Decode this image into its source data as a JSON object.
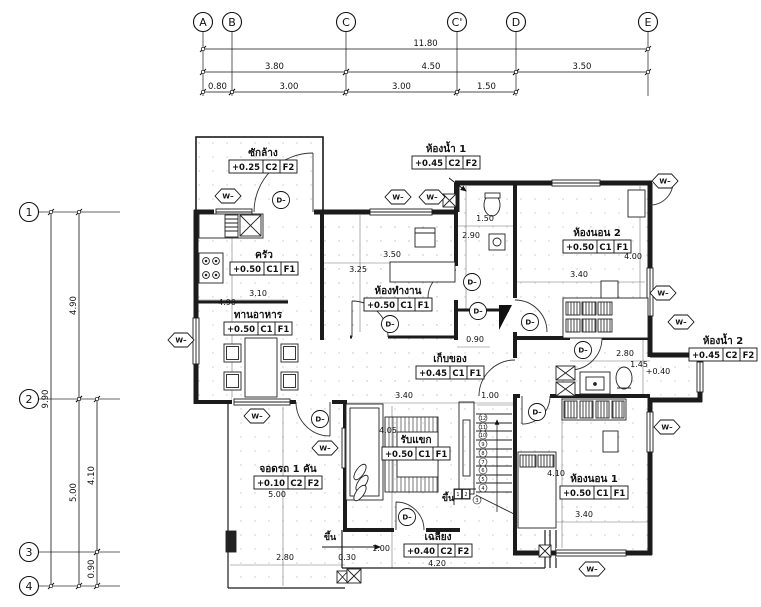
{
  "drawing": {
    "title": "First floor plan",
    "line_color": "#1b1b1b",
    "column_grid": {
      "bubble_y": 22,
      "bubbles": [
        {
          "label": "A",
          "x": 203
        },
        {
          "label": "B",
          "x": 232
        },
        {
          "label": "C",
          "x": 346
        },
        {
          "label": "C'",
          "x": 457
        },
        {
          "label": "D",
          "x": 516
        },
        {
          "label": "E",
          "x": 648
        }
      ]
    },
    "row_grid": {
      "bubble_x": 29,
      "bubbles": [
        {
          "label": "1",
          "y": 212
        },
        {
          "label": "2",
          "y": 399
        },
        {
          "label": "3",
          "y": 552
        },
        {
          "label": "4",
          "y": 586
        }
      ]
    },
    "h_dimensions": [
      {
        "label": "11.80",
        "x1": 203,
        "x2": 648,
        "y": 49
      },
      {
        "label": "3.80",
        "x1": 203,
        "x2": 346,
        "y": 72
      },
      {
        "label": "4.50",
        "x1": 346,
        "x2": 516,
        "y": 72
      },
      {
        "label": "3.50",
        "x1": 516,
        "x2": 648,
        "y": 72
      },
      {
        "label": "0.80",
        "x1": 203,
        "x2": 232,
        "y": 92
      },
      {
        "label": "3.00",
        "x1": 232,
        "x2": 346,
        "y": 92
      },
      {
        "label": "3.00",
        "x1": 346,
        "x2": 457,
        "y": 92
      },
      {
        "label": "1.50",
        "x1": 457,
        "x2": 516,
        "y": 92
      }
    ],
    "v_dimensions": [
      {
        "label": "9.90",
        "x": 51,
        "y1": 212,
        "y2": 586
      },
      {
        "label": "4.90",
        "x": 79,
        "y1": 212,
        "y2": 399
      },
      {
        "label": "5.00",
        "x": 79,
        "y1": 399,
        "y2": 586
      },
      {
        "label": "4.10",
        "x": 97,
        "y1": 399,
        "y2": 552
      },
      {
        "label": "0.90",
        "x": 97,
        "y1": 552,
        "y2": 586
      }
    ],
    "rooms": [
      {
        "name": "ซักล้าง",
        "level": "+0.25",
        "c": "C2",
        "f": "F2",
        "x": 263,
        "y": 156
      },
      {
        "name": "ครัว",
        "level": "+0.50",
        "c": "C1",
        "f": "F1",
        "x": 264,
        "y": 258
      },
      {
        "name": "ทานอาหาร",
        "level": "+0.50",
        "c": "C1",
        "f": "F1",
        "x": 258,
        "y": 318
      },
      {
        "name": "ห้องทำงาน",
        "level": "+0.50",
        "c": "C1",
        "f": "F1",
        "x": 398,
        "y": 294
      },
      {
        "name": "ห้องน้ำ 1",
        "level": "+0.45",
        "c": "C2",
        "f": "F2",
        "x": 446,
        "y": 152
      },
      {
        "name": "ห้องนอน 2",
        "level": "+0.50",
        "c": "C1",
        "f": "F1",
        "x": 597,
        "y": 236
      },
      {
        "name": "ห้องน้ำ 2",
        "level": "+0.45",
        "c": "C2",
        "f": "F2",
        "x": 723,
        "y": 344
      },
      {
        "name": "เก็บของ",
        "level": "+0.45",
        "c": "C1",
        "f": "F1",
        "x": 450,
        "y": 362
      },
      {
        "name": "รับแขก",
        "level": "+0.50",
        "c": "C1",
        "f": "F1",
        "x": 416,
        "y": 443
      },
      {
        "name": "จอดรถ 1 คัน",
        "level": "+0.10",
        "c": "C2",
        "f": "F2",
        "x": 288,
        "y": 472
      },
      {
        "name": "ห้องนอน 1",
        "level": "+0.50",
        "c": "C1",
        "f": "F1",
        "x": 594,
        "y": 482
      },
      {
        "name": "เฉลียง",
        "level": "+0.40",
        "c": "C2",
        "f": "F2",
        "x": 438,
        "y": 540
      }
    ],
    "plan_dimensions": [
      {
        "label": "3.10",
        "x": 258,
        "y": 296
      },
      {
        "label": "4.90",
        "x": 227,
        "y": 305
      },
      {
        "label": "3.50",
        "x": 392,
        "y": 257
      },
      {
        "label": "3.25",
        "x": 358,
        "y": 272
      },
      {
        "label": "1.50",
        "x": 485,
        "y": 221
      },
      {
        "label": "2.90",
        "x": 471,
        "y": 238
      },
      {
        "label": "4.00",
        "x": 633,
        "y": 259
      },
      {
        "label": "3.40",
        "x": 579,
        "y": 277
      },
      {
        "label": "2.80",
        "x": 625,
        "y": 356
      },
      {
        "label": "1.45",
        "x": 639,
        "y": 367
      },
      {
        "label": "+0.40",
        "x": 658,
        "y": 374
      },
      {
        "label": "0.90",
        "x": 475,
        "y": 342
      },
      {
        "label": "3.40",
        "x": 404,
        "y": 398
      },
      {
        "label": "1.00",
        "x": 490,
        "y": 398
      },
      {
        "label": "4.05",
        "x": 388,
        "y": 433
      },
      {
        "label": "5.00",
        "x": 277,
        "y": 497
      },
      {
        "label": "2.80",
        "x": 285,
        "y": 560
      },
      {
        "label": "0.30",
        "x": 347,
        "y": 560
      },
      {
        "label": "4.10",
        "x": 556,
        "y": 476
      },
      {
        "label": "3.40",
        "x": 584,
        "y": 517
      },
      {
        "label": "1.00",
        "x": 381,
        "y": 551
      },
      {
        "label": "4.20",
        "x": 437,
        "y": 566
      }
    ],
    "up_labels": [
      {
        "label": "ขึ้น",
        "x": 330,
        "y": 540
      },
      {
        "label": "ขึ้น",
        "x": 448,
        "y": 501
      }
    ],
    "symbols": {
      "window_label": "W–",
      "door_label": "D–",
      "windows": [
        {
          "x": 228,
          "y": 196
        },
        {
          "x": 398,
          "y": 197
        },
        {
          "x": 432,
          "y": 197
        },
        {
          "x": 181,
          "y": 340
        },
        {
          "x": 257,
          "y": 416
        },
        {
          "x": 325,
          "y": 448
        },
        {
          "x": 665,
          "y": 181
        },
        {
          "x": 663,
          "y": 293
        },
        {
          "x": 681,
          "y": 322
        },
        {
          "x": 667,
          "y": 427
        },
        {
          "x": 592,
          "y": 569
        }
      ],
      "doors": [
        {
          "x": 281,
          "y": 200
        },
        {
          "x": 390,
          "y": 324
        },
        {
          "x": 472,
          "y": 282
        },
        {
          "x": 478,
          "y": 311
        },
        {
          "x": 530,
          "y": 322
        },
        {
          "x": 583,
          "y": 350
        },
        {
          "x": 537,
          "y": 412
        },
        {
          "x": 407,
          "y": 517
        },
        {
          "x": 320,
          "y": 419
        }
      ]
    },
    "stairs": {
      "numbers": [
        {
          "n": "12",
          "x": 483,
          "y": 418
        },
        {
          "n": "11",
          "x": 483,
          "y": 427
        },
        {
          "n": "10",
          "x": 483,
          "y": 435
        },
        {
          "n": "9",
          "x": 483,
          "y": 444
        },
        {
          "n": "8",
          "x": 483,
          "y": 453
        },
        {
          "n": "7",
          "x": 483,
          "y": 462
        },
        {
          "n": "6",
          "x": 483,
          "y": 470
        },
        {
          "n": "5",
          "x": 483,
          "y": 479
        },
        {
          "n": "4",
          "x": 483,
          "y": 488
        },
        {
          "n": "3",
          "x": 477,
          "y": 500
        },
        {
          "n": "2",
          "x": 466,
          "y": 494
        },
        {
          "n": "1",
          "x": 458,
          "y": 494
        }
      ]
    }
  }
}
